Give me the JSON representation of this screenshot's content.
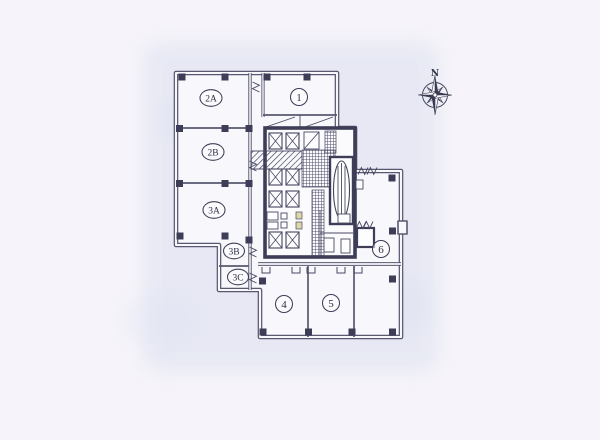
{
  "page": {
    "background": "#f6f4fa",
    "paper_tint": "#e2e5f2"
  },
  "floor_plan": {
    "rooms": [
      {
        "id": "2A",
        "label": "2A"
      },
      {
        "id": "2B",
        "label": "2B"
      },
      {
        "id": "3A",
        "label": "3A"
      },
      {
        "id": "3B",
        "label": "3B"
      },
      {
        "id": "3C",
        "label": "3C"
      },
      {
        "id": "1",
        "label": "1"
      },
      {
        "id": "4",
        "label": "4"
      },
      {
        "id": "5",
        "label": "5"
      },
      {
        "id": "6",
        "label": "6"
      }
    ],
    "compass": {
      "label": "N"
    },
    "colors": {
      "wall": "#585870",
      "core_wall": "#3d3d58",
      "label_text": "#2e2e46",
      "fixture_accent": "#ddd6a6"
    }
  }
}
